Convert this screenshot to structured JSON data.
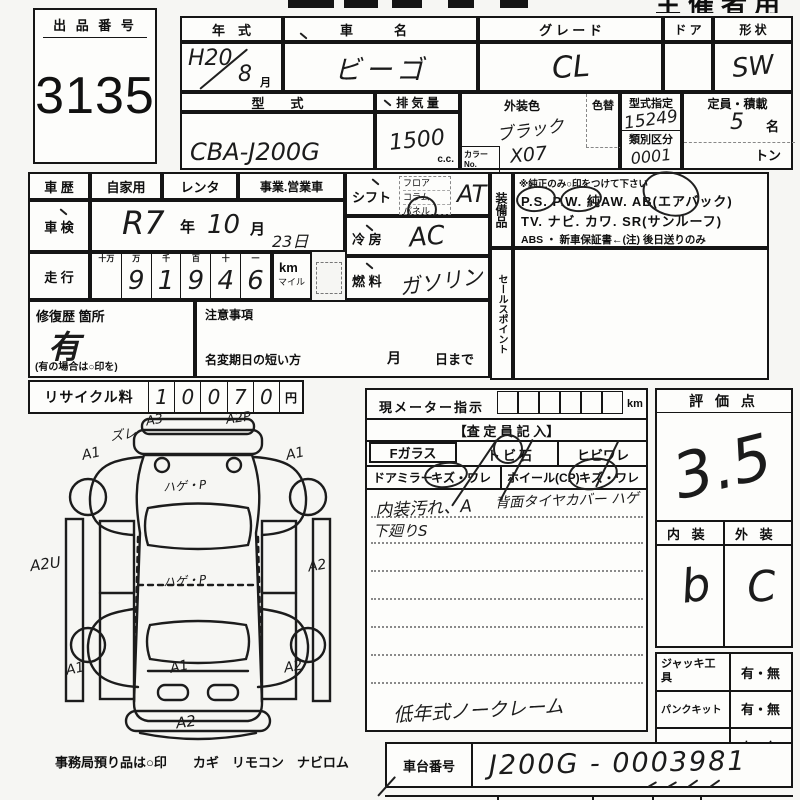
{
  "sheet": {
    "top_right_title": "主催者用",
    "lot": {
      "label": "出 品 番 号",
      "number": "3135"
    },
    "vehicle": {
      "year_label": "年　式",
      "year_era": "H20",
      "year_month": "8",
      "month_unit": "月",
      "name_label": "車　名",
      "name_value": "ビーゴ",
      "grade_label": "グ レ ー ド",
      "grade_value": "CL",
      "door_label": "ド ア",
      "shape_label": "形 状",
      "shape_value": "SW",
      "model_label": "型　　式",
      "model_value": "CBA-J200G",
      "disp_label": "排 気 量",
      "disp_value": "1500",
      "disp_unit": "c.c.",
      "color_label": "外装色",
      "color_value": "ブラック",
      "color_change_label": "色替",
      "color_no_label": "カラーNo.",
      "color_no_value": "X07",
      "type_desig_label": "型式指定",
      "type_desig_value": "15249",
      "class_label": "類別区分",
      "class_value": "0001",
      "capacity_label": "定員・積載",
      "capacity_value": "5",
      "capacity_unit": "名",
      "load_unit": "トン"
    },
    "history": {
      "label": "車 歴",
      "private": "自家用",
      "rental": "レンタ",
      "business": "事業.営業車"
    },
    "shaken": {
      "label": "車 検",
      "era": "R7",
      "year_unit": "年",
      "month": "10",
      "month_unit": "月",
      "day": "23日"
    },
    "odometer": {
      "label": "走 行",
      "col_headers": [
        "十万",
        "万",
        "千",
        "百",
        "十",
        "一"
      ],
      "digits": [
        "",
        "9",
        "1",
        "9",
        "4",
        "6"
      ],
      "unit_km": "km",
      "unit_mile": "マイル"
    },
    "shift": {
      "label": "シフト",
      "floor": "フロア",
      "column": "コラム",
      "panel": "パネル",
      "value": "AT"
    },
    "ac": {
      "label": "冷 房",
      "value": "AC"
    },
    "fuel": {
      "label": "燃 料",
      "value": "ガソリン"
    },
    "repair": {
      "label": "修復歴 箇所",
      "value": "有",
      "note": "(有の場合は○印を)"
    },
    "caution": {
      "label": "注意事項",
      "transfer_note": "名変期日の短い方",
      "month_unit": "月",
      "day_unit": "日まで"
    },
    "recycle": {
      "label": "リサイクル料",
      "digits": [
        "1",
        "0",
        "0",
        "7",
        "0"
      ],
      "unit": "円"
    },
    "equipment": {
      "vert_label": "装備品",
      "note": "※純正のみ○印をつけて下さい",
      "line1": "P.S.  P.W.  純AW.  AB(エアバック)",
      "line2": "TV.  ナビ.  カワ.  SR(サンルーフ)",
      "line3": "ABS ・ 新車保証書←(注) 後日送りのみ",
      "sales_label": "セールスポイント"
    },
    "meter": {
      "label": "現メーター指示",
      "unit": "km"
    },
    "assessor": {
      "header": "【査 定 員 記 入】",
      "f_glass": "Fガラス",
      "tobi": "トビ石",
      "hibi": "ヒビワレ",
      "mirror": "ドアミラー",
      "mirror_dmg": "キズ・ワレ",
      "wheel": "ホイール(CP)",
      "wheel_dmg": "キズ・ワレ",
      "note1": "内装汚れ、A",
      "note2": "背面タイヤカバー ハゲ",
      "note3": "下廻りS",
      "bottom_note": "低年式ノークレーム"
    },
    "rating": {
      "header": "評 価 点",
      "score": "3.5",
      "interior_label": "内 装",
      "exterior_label": "外 装",
      "interior": "b",
      "exterior": "C"
    },
    "tools": {
      "rows": [
        {
          "label": "ジャッキ工具",
          "value": "有・無"
        },
        {
          "label": "パンクキット",
          "value": "有・無"
        },
        {
          "label": "スペアタイヤ",
          "value": "有・無"
        }
      ]
    },
    "chassis": {
      "label": "車台番号",
      "value": "J200G - 0003981"
    },
    "office_note": "事務局預り品は○印　　カギ　リモコン　ナビロム",
    "diagram": {
      "annotations": [
        {
          "t": "ズレ"
        },
        {
          "t": "A3"
        },
        {
          "t": "A2P"
        },
        {
          "t": "A1"
        },
        {
          "t": "A1"
        },
        {
          "t": "ハゲ・P"
        },
        {
          "t": "A2U"
        },
        {
          "t": "A2"
        },
        {
          "t": "ハゲ・P"
        },
        {
          "t": "A1"
        },
        {
          "t": "A1"
        },
        {
          "t": "A2"
        },
        {
          "t": "A2"
        }
      ]
    }
  }
}
